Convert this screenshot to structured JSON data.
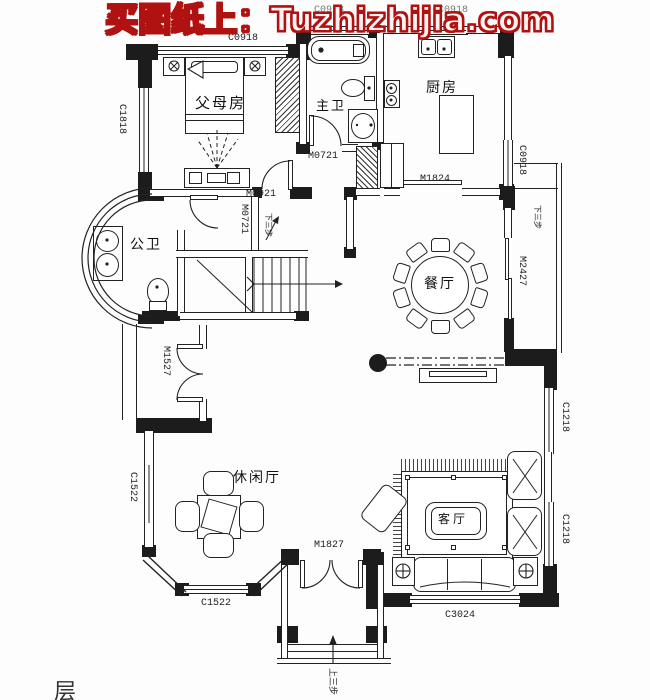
{
  "watermark": {
    "text": "买图纸上：Tuzhizhijia.com",
    "color": "#b01212"
  },
  "rooms": {
    "parents_bedroom": "父母房",
    "master_bath": "主卫",
    "kitchen": "厨房",
    "public_bath": "公卫",
    "dining": "餐厅",
    "leisure": "休闲厅",
    "living": "客厅"
  },
  "dims": {
    "c0918_top": "C0918",
    "c0918_bath_top": "C0918",
    "c0918_kitchen_top": "C0918",
    "c1818": "C1818",
    "m0721_bath": "M0721",
    "m0721_hall": "M0721",
    "m0921": "M0921",
    "m1824": "M1824",
    "c0918_right": "C0918",
    "m2427": "M2427",
    "m1527": "M1527",
    "c1522_left": "C1522",
    "c1522_bottom": "C1522",
    "m1827": "M1827",
    "c3024": "C3024",
    "c1218_upper": "C1218",
    "c1218_lower": "C1218"
  },
  "annotations": {
    "down_3_steps_hall": "下三步",
    "down_3_steps_side": "下三步",
    "up_3_steps_entry": "上三步",
    "corner_partial_text": "层"
  }
}
